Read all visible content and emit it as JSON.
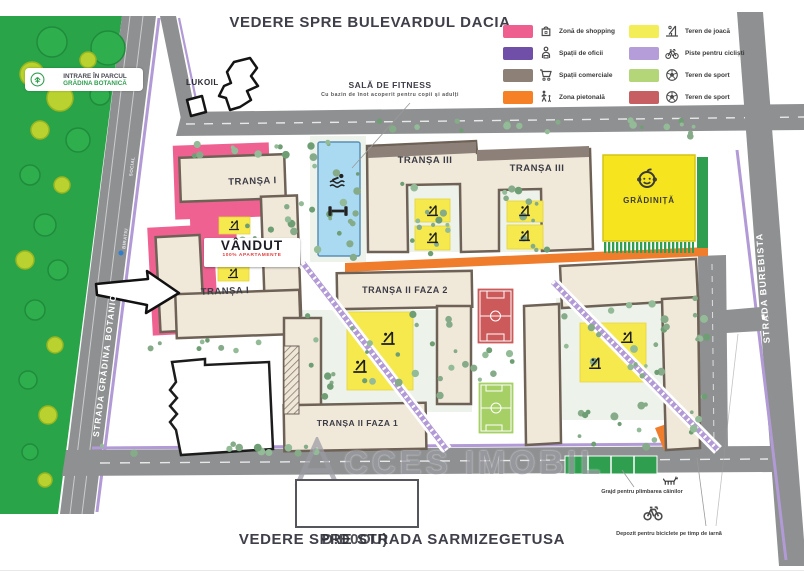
{
  "titles": {
    "top": "VEDERE SPRE BULEVARDUL DACIA",
    "bottom": "VEDERE SPRE STRADA SARMIZEGETUSA",
    "bottom_overlap": "Đ!Đ0OU)"
  },
  "watermark": {
    "prefix_letter": "A",
    "text": "CCES IMOBIL"
  },
  "park": {
    "label_line1": "INTRARE ÎN PARCUL",
    "label_line2": "GRĂDINA BOTANICĂ"
  },
  "streets": {
    "left_vertical": "STRADA GRĂDINA BOTANICĂ",
    "right_vertical": "STRADA BUREBISTA",
    "road_small_label_1": "SOCIAL",
    "road_small_label_2": "BIRATIU"
  },
  "poi": {
    "lukoil": "LUKOIL",
    "fitness_title": "SALĂ DE FITNESS",
    "fitness_subtitle": "Cu bazin de înot acoperit pentru copii și adulți",
    "gradinita": "GRĂDINIȚĂ"
  },
  "buildings": {
    "transa1_upper": "TRANȘA I",
    "transa1_lower": "TRANȘA I",
    "transa3_left": "TRANȘA III",
    "transa3_right": "TRANȘA III",
    "transa2_faza2": "TRANȘA II FAZA 2",
    "transa2_faza1": "TRANȘA II FAZA 1"
  },
  "sold_badge": {
    "title": "VÂNDUT",
    "subtitle": "100% APARTAMENTE"
  },
  "annotations": {
    "dog_area": "Grajd pentru plimbarea câinilor",
    "bike_storage": "Depozit pentru biciclete pe timp de iarnă"
  },
  "legend": {
    "items": [
      {
        "color": "#ee5f8f",
        "icon": "shopping-bag-icon",
        "label": "Zonă de shopping"
      },
      {
        "color": "#6f4fa8",
        "icon": "office-icon",
        "label": "Spații de oficii"
      },
      {
        "color": "#8d8076",
        "icon": "shopping-cart-icon",
        "label": "Spații comerciale"
      },
      {
        "color": "#f58025",
        "icon": "pedestrian-icon",
        "label": "Zona pietonală"
      },
      {
        "color": "#f3ee57",
        "icon": "playground-icon",
        "label": "Teren de joacă"
      },
      {
        "color": "#b49dd8",
        "icon": "bicycle-icon",
        "label": "Piste pentru cicliști"
      },
      {
        "color": "#b5d579",
        "icon": "soccer-ball-icon",
        "label": "Teren de sport"
      },
      {
        "color": "#c75f62",
        "icon": "soccer-ball-icon",
        "label": "Teren de sport"
      }
    ]
  },
  "colors": {
    "park_green": "#29a449",
    "road_gray": "#8e9091",
    "building_beige": "#f0e9da",
    "building_border": "#6e6156",
    "pink_zone": "#ee6190",
    "playground_yellow": "#f6e94e",
    "pool_blue": "#a9daf2",
    "kindergarten_yellow": "#f6e51e",
    "bike_path_purple": "#b29ad6",
    "pedestrian_orange": "#ef7d2c",
    "field_red": "#cc5a5a",
    "field_green": "#a6cf65"
  }
}
